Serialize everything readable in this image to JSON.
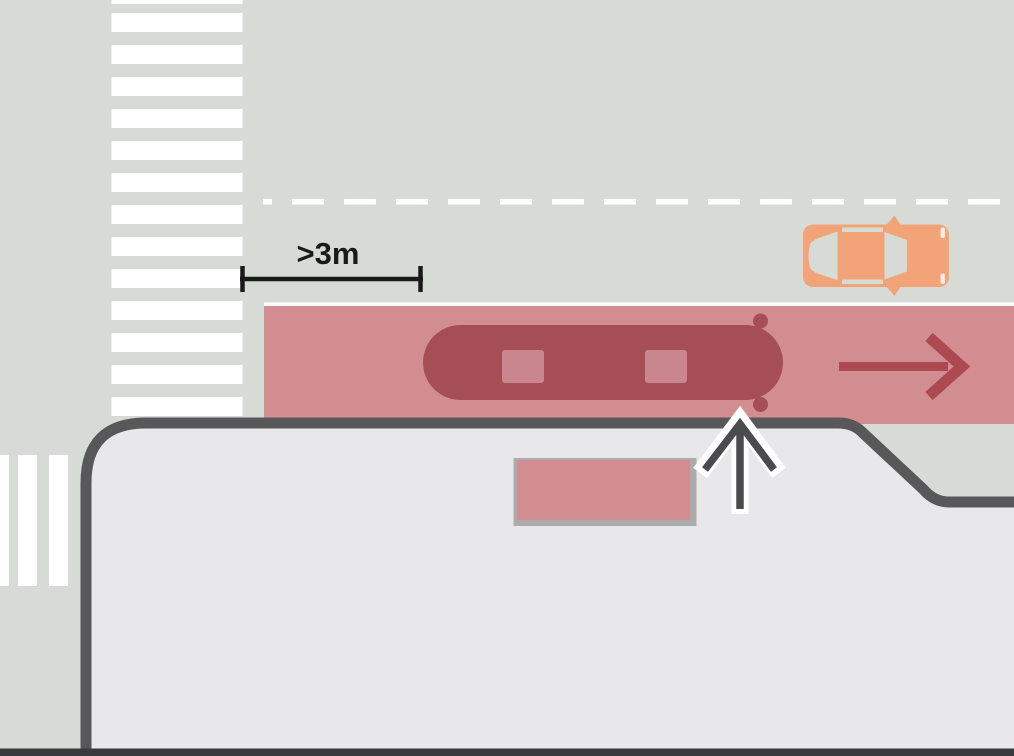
{
  "scene": {
    "type": "traffic-diagram",
    "measurement_label": ">3m",
    "elements": [
      {
        "name": "pedestrian-crossing-top",
        "label": "zebra crossing across main road"
      },
      {
        "name": "pedestrian-crossing-left",
        "label": "zebra crossing across side road"
      },
      {
        "name": "lane-divider-dashed-line",
        "label": "dashed lane divider"
      },
      {
        "name": "bus-lane",
        "label": "red bus lane"
      },
      {
        "name": "bus",
        "label": "bus stopped in bus lane"
      },
      {
        "name": "bus-lane-direction-arrow",
        "label": "travel direction arrow"
      },
      {
        "name": "car",
        "label": "car in opposite lane"
      },
      {
        "name": "sidewalk",
        "label": "sidewalk with boarding area"
      },
      {
        "name": "bus-stop-marking",
        "label": "bus stop waiting area marking"
      },
      {
        "name": "boarding-arrow",
        "label": "boarding direction arrow"
      },
      {
        "name": "distance-measurement",
        "label": "distance from crossing to bus lane start"
      }
    ]
  },
  "colors": {
    "road": "#D6DCD5",
    "stripe_white": "#FFFFFF",
    "lane_pink": "#D18D90",
    "bus_red": "#A54E55",
    "bus_window_pink": "#C9868D",
    "arrow_red": "#AD4950",
    "car_orange": "#F2A377",
    "car_headlight": "#F8EDE4",
    "sidewalk_fill": "#E8E7EA",
    "sidewalk_border": "#58585A",
    "marking_gray_border": "#ACACAC",
    "direction_arrow_dark": "#4B4B4D",
    "measure_black": "#1A1A1A",
    "bottom_bar": "#37393B"
  }
}
